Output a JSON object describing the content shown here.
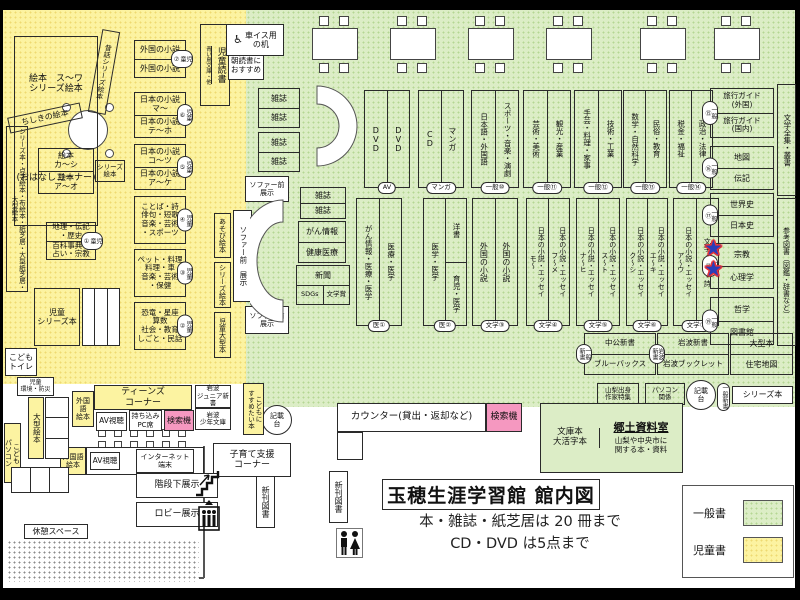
{
  "title": "玉穂生涯学習館 館内図",
  "rules": {
    "line1": "本・雑誌・紙芝居は 20 冊まで",
    "line2": "CD・DVD は5点まで"
  },
  "legend": {
    "general": "一般書",
    "children": "児童書"
  },
  "colors": {
    "general_zone": "#dcedc6",
    "children_zone": "#fcf3a1",
    "search_pink": "#f598c0",
    "star_blue": "#2b3db8",
    "star_red": "#e53238"
  },
  "icons": {
    "wheelchair": "♿",
    "star": "★"
  },
  "items": [
    {
      "id": "y1",
      "name": "ohanashi-corner",
      "kind": "stack",
      "cells": [
        "絵本　ス〜ワ\nシリーズ絵本",
        "(おはなしコーナー)"
      ]
    },
    {
      "id": "y2",
      "name": "mukashibanashi-series-shelf",
      "kind": "vlabel",
      "label": "昔話シリーズ絵本"
    },
    {
      "id": "y3",
      "name": "chishiki-ehon-shelf",
      "kind": "label",
      "label": "ちしきの絵本"
    },
    {
      "id": "y5",
      "name": "picture-books-shelf",
      "kind": "stack",
      "cells": [
        "絵本\nカ〜シ",
        "絵本\nア〜オ"
      ]
    },
    {
      "id": "y6",
      "name": "series-ehon-tag",
      "kind": "label",
      "label": "シリーズ\n絵本"
    },
    {
      "id": "y7",
      "name": "left-wall-shelf",
      "kind": "vlabel",
      "label": "シリーズ本・点字絵本・布絵本・紙芝居・大型紙芝居・大型絵本"
    },
    {
      "id": "y8",
      "name": "geography-biography-shelf",
      "kind": "htag",
      "cells": [
        "地理・伝記\n・歴史",
        "百科事典・\n占い・宗教"
      ],
      "tag": "児童①"
    },
    {
      "id": "y9",
      "name": "children-series-shelf",
      "kind": "label",
      "label": "児童\nシリーズ本"
    },
    {
      "id": "y10",
      "name": "shelf-unit",
      "kind": "plain"
    },
    {
      "id": "y11",
      "name": "children-toilet",
      "kind": "label",
      "label": "こども\nトイレ"
    },
    {
      "id": "y12",
      "name": "children-shelf-7",
      "kind": "htag",
      "cells": [
        "外国の小説",
        "外国の小説"
      ],
      "tag": "児童⑦"
    },
    {
      "id": "y13",
      "name": "children-shelf-6",
      "kind": "htag",
      "cells": [
        "日本の小説\nマ〜",
        "日本の小説\nテ〜ホ"
      ],
      "tag": "児童⑥"
    },
    {
      "id": "y14",
      "name": "children-shelf-5",
      "kind": "htag",
      "cells": [
        "日本の小説\nコ〜ツ",
        "日本の小説\nア〜ケ"
      ],
      "tag": "児童⑤"
    },
    {
      "id": "y15",
      "name": "children-shelf-4",
      "kind": "htag",
      "cells": [
        "ことば・詩\n俳句・短歌\n音楽・芸術\n・スポーツ"
      ],
      "tag": "児童④"
    },
    {
      "id": "y16",
      "name": "children-shelf-3",
      "kind": "htag",
      "cells": [
        "ペット・料理\n料理・車\n音楽・芸術\n・保健"
      ],
      "tag": "児童③"
    },
    {
      "id": "y17",
      "name": "children-shelf-2",
      "kind": "htag",
      "cells": [
        "恐竜・星座\n算数\n社会・教育\nしごと・民話"
      ],
      "tag": "児童②"
    },
    {
      "id": "y18",
      "name": "asobi-ehon-shelf",
      "kind": "vlabel",
      "label": "あそび絵本"
    },
    {
      "id": "y19",
      "name": "series-ehon-shelf",
      "kind": "vlabel",
      "label": "シリーズ絵本"
    },
    {
      "id": "y20",
      "name": "children-large-books-shelf",
      "kind": "vlabel",
      "label": "児童大型本"
    },
    {
      "id": "y21",
      "name": "children-reading-shelf",
      "kind": "vpair",
      "sub": "青い鳥文庫・他",
      "label": "児童読書"
    },
    {
      "id": "y22",
      "name": "morning-reading-display",
      "kind": "label",
      "label": "朝読書に\nおすすめ"
    },
    {
      "id": "g1",
      "name": "wheelchair-desk",
      "kind": "wheel",
      "label": "車イス用\nの机"
    },
    {
      "id": "g2",
      "name": "magazine-rack",
      "kind": "stack",
      "cells": [
        "雑誌",
        "雑誌"
      ]
    },
    {
      "id": "g3",
      "name": "magazine-rack",
      "kind": "stack",
      "cells": [
        "雑誌",
        "雑誌"
      ]
    },
    {
      "id": "g5",
      "name": "sofa-front-display",
      "kind": "label",
      "label": "ソファー前\n展示"
    },
    {
      "id": "g6",
      "name": "sofa-front-display",
      "kind": "vlabel",
      "label": "ソファー前　展示"
    },
    {
      "id": "g8",
      "name": "sofa-front-display",
      "kind": "label",
      "label": "ソファー前\n展示"
    },
    {
      "id": "g9",
      "name": "magazine-rack",
      "kind": "stack",
      "cells": [
        "雑誌",
        "雑誌"
      ]
    },
    {
      "id": "g10",
      "name": "cancer-health-info-rack",
      "kind": "stack",
      "cells": [
        "がん情報",
        "健康医療"
      ]
    },
    {
      "id": "g11",
      "name": "newspaper-rack",
      "kind": "newspaper",
      "cells": [
        "新聞",
        "SDGs",
        "文学賞"
      ]
    },
    {
      "id": "r1",
      "name": "shelf-av",
      "kind": "vshelf",
      "cols": [
        "DVD",
        "DVD"
      ],
      "tag": "AV"
    },
    {
      "id": "r2",
      "name": "shelf-manga",
      "kind": "vshelf",
      "cols": [
        "CD",
        "マンガ"
      ],
      "tag": "マンガ"
    },
    {
      "id": "r3",
      "name": "shelf-general-10",
      "kind": "vshelf",
      "cols": [
        "日本語・外国語",
        "スポーツ・音楽・演劇"
      ],
      "tag": "一般⑩"
    },
    {
      "id": "r4",
      "name": "shelf-general-11",
      "kind": "vshelf",
      "cols": [
        "芸術・美術",
        "観光・産業"
      ],
      "tag": "一般⑪"
    },
    {
      "id": "r5",
      "name": "shelf-general-12",
      "kind": "vshelf",
      "cols": [
        "手芸・料理・家事",
        "技術・工業"
      ],
      "tag": "一般⑫"
    },
    {
      "id": "r6",
      "name": "shelf-general-13",
      "kind": "vshelf",
      "cols": [
        "数学・自然科学",
        "民俗・教育"
      ],
      "tag": "一般⑬"
    },
    {
      "id": "r7",
      "name": "shelf-general-14",
      "kind": "vshelf",
      "cols": [
        "税金・福祉",
        "政治・法律"
      ],
      "tag": "一般⑭"
    },
    {
      "id": "r8",
      "name": "shelf-general-15",
      "kind": "htag",
      "cells": [
        "旅行ガイド\n(外国)",
        "旅行ガイド\n(国内)"
      ],
      "tag": "一般⑮"
    },
    {
      "id": "r9",
      "name": "shelf-general-16",
      "kind": "htag",
      "cells": [
        "地図",
        "伝記"
      ],
      "tag": "一般⑯"
    },
    {
      "id": "r10",
      "name": "literature-collection-shelf",
      "kind": "vlabel",
      "label": "文学全集・叢書"
    },
    {
      "id": "s1",
      "name": "shelf-medical-1",
      "kind": "vshelf",
      "cols": [
        "がん情報・医療・医学",
        "医療・医学"
      ],
      "tag": "医①"
    },
    {
      "id": "s2",
      "name": "shelf-medical-2",
      "kind": "split",
      "cols": [
        "医学・医学",
        "洋書",
        "育児・医学"
      ],
      "tag": "医②"
    },
    {
      "id": "s3",
      "name": "shelf-literature-3",
      "kind": "vshelf",
      "cols": [
        "外国の小説",
        "外国の小説"
      ],
      "tag": "文学③"
    },
    {
      "id": "s4",
      "name": "shelf-literature-4",
      "kind": "vshelf",
      "cols": [
        "日本の小説・エッセイ\nモ〜",
        "日本の小説・エッセイ\nフ〜メ"
      ],
      "tag": "文学④"
    },
    {
      "id": "s5",
      "name": "shelf-literature-5",
      "kind": "vshelf",
      "cols": [
        "日本の小説・エッセイ\nナ〜ヒ",
        "日本の小説・エッセイ\nス〜ト"
      ],
      "tag": "文学⑤"
    },
    {
      "id": "s6",
      "name": "shelf-literature-6",
      "kind": "vshelf",
      "cols": [
        "日本の小説・エッセイ\nク〜シ",
        "日本の小説・エッセイ\nエ〜キ"
      ],
      "tag": "文学⑥"
    },
    {
      "id": "s7",
      "name": "shelf-literature-7",
      "kind": "vshelf",
      "cols": [
        "日本の小説・エッセイ\nア〜ウ",
        "文学・俳句・詩"
      ],
      "tag": "文学⑦"
    },
    {
      "id": "s8",
      "name": "shelf-general-17",
      "kind": "htag",
      "cells": [
        "世界史",
        "日本史"
      ],
      "tag": "一般⑰"
    },
    {
      "id": "s9",
      "name": "shelf-general-18",
      "kind": "htag",
      "cells": [
        "宗教",
        "心理学"
      ],
      "tag": "一般⑱"
    },
    {
      "id": "s10",
      "name": "shelf-general-19",
      "kind": "htag",
      "cells": [
        "哲学",
        "図書館"
      ],
      "tag": "一般⑲"
    },
    {
      "id": "s11",
      "name": "reference-books-shelf",
      "kind": "vlabel",
      "label": "参考図書（図鑑・辞書など）"
    },
    {
      "id": "t1",
      "name": "shinsho-chuko-shelf",
      "kind": "htag",
      "cells": [
        "中公新書",
        "ブルーバックス"
      ],
      "tag": "一般新書"
    },
    {
      "id": "t2",
      "name": "shinsho-iwanami-shelf",
      "kind": "htag",
      "cells": [
        "岩波新書",
        "岩波ブックレット"
      ],
      "tag": "岩波新書"
    },
    {
      "id": "t3",
      "name": "large-books-shelf",
      "kind": "stack",
      "cells": [
        "大型本",
        "住宅地図"
      ]
    },
    {
      "id": "t4",
      "name": "yamanashi-authors-display",
      "kind": "label",
      "label": "山梨出身\n作家特集"
    },
    {
      "id": "t5",
      "name": "pc-related-shelf",
      "kind": "label",
      "label": "パソコン\n関係"
    },
    {
      "id": "t6",
      "name": "writing-stand",
      "kind": "circle",
      "label": "記載\n台"
    },
    {
      "id": "t7",
      "name": "shinsho-tag",
      "kind": "vlabel",
      "label": "一般新書"
    },
    {
      "id": "t8",
      "name": "series-books-shelf",
      "kind": "label",
      "label": "シリーズ本"
    },
    {
      "id": "k1",
      "name": "local-materials-room",
      "kind": "kyodo",
      "left": "文庫本\n大活字本",
      "title": "郷土資料室",
      "desc": "山梨や中央市に\n関する本・資料"
    },
    {
      "id": "c1",
      "name": "service-counter",
      "kind": "label",
      "label": "カウンター(貸出・返却など)"
    },
    {
      "id": "c2",
      "name": "search-terminal",
      "kind": "label",
      "label": "検索機"
    },
    {
      "id": "c3",
      "name": "counter-leg",
      "kind": "plain"
    },
    {
      "id": "c4",
      "name": "writing-stand",
      "kind": "circle",
      "label": "記載\n台"
    },
    {
      "id": "u1",
      "name": "foreign-picture-books",
      "kind": "label",
      "label": "外国語\n絵本"
    },
    {
      "id": "u2",
      "name": "teens-corner",
      "kind": "label",
      "label": "ティーンズ\nコーナー"
    },
    {
      "id": "u3",
      "name": "av-booth",
      "kind": "label",
      "label": "AV視聴"
    },
    {
      "id": "u4",
      "name": "byod-pc-seat",
      "kind": "label",
      "label": "持ち込み\nPC席"
    },
    {
      "id": "u5",
      "name": "search-terminal",
      "kind": "label",
      "label": "検索機"
    },
    {
      "id": "u6",
      "name": "iwanami-junior-shinsho",
      "kind": "label",
      "label": "岩波\nジュニア新書"
    },
    {
      "id": "u7",
      "name": "iwanami-shonen-bunko",
      "kind": "label",
      "label": "岩波\n少年文庫"
    },
    {
      "id": "u8",
      "name": "recommended-for-kids",
      "kind": "vlabel",
      "label": "こどもに\nすすめたい本"
    },
    {
      "id": "u10",
      "name": "foreign-picture-books",
      "kind": "label",
      "label": "外国語\n絵本"
    },
    {
      "id": "u11",
      "name": "av-internet-shelf",
      "kind": "plain"
    },
    {
      "id": "u11a",
      "name": "av-booth",
      "kind": "label",
      "label": "AV視聴"
    },
    {
      "id": "u11b",
      "name": "internet-terminal",
      "kind": "label",
      "label": "インターネット\n端末"
    },
    {
      "id": "u12",
      "name": "childcare-support-corner",
      "kind": "label",
      "label": "子育て支援\nコーナー"
    },
    {
      "id": "b1",
      "name": "children-environment-shelf",
      "kind": "label",
      "label": "児童\n環境・防災"
    },
    {
      "id": "b2",
      "name": "large-picture-books",
      "kind": "vlabel",
      "label": "大型絵本"
    },
    {
      "id": "b3",
      "name": "shelf-unit",
      "kind": "plain"
    },
    {
      "id": "b4",
      "name": "kids-computer",
      "kind": "vlabel",
      "label": "こども\nパソコン"
    },
    {
      "id": "b5",
      "name": "shelf-unit",
      "kind": "plain"
    },
    {
      "id": "b6",
      "name": "rest-space-label",
      "kind": "label",
      "label": "休憩スペース"
    },
    {
      "id": "b7",
      "name": "rest-space-area",
      "kind": "plain"
    },
    {
      "id": "b8",
      "name": "under-stairs-display",
      "kind": "label",
      "label": "階段下展示"
    },
    {
      "id": "b10",
      "name": "lobby-display",
      "kind": "label",
      "label": "ロビー展示"
    },
    {
      "id": "b12",
      "name": "new-books-shelf",
      "kind": "vlabel",
      "label": "新刊図書"
    },
    {
      "id": "b13",
      "name": "new-books-shelf",
      "kind": "vlabel",
      "label": "新刊図書"
    }
  ]
}
